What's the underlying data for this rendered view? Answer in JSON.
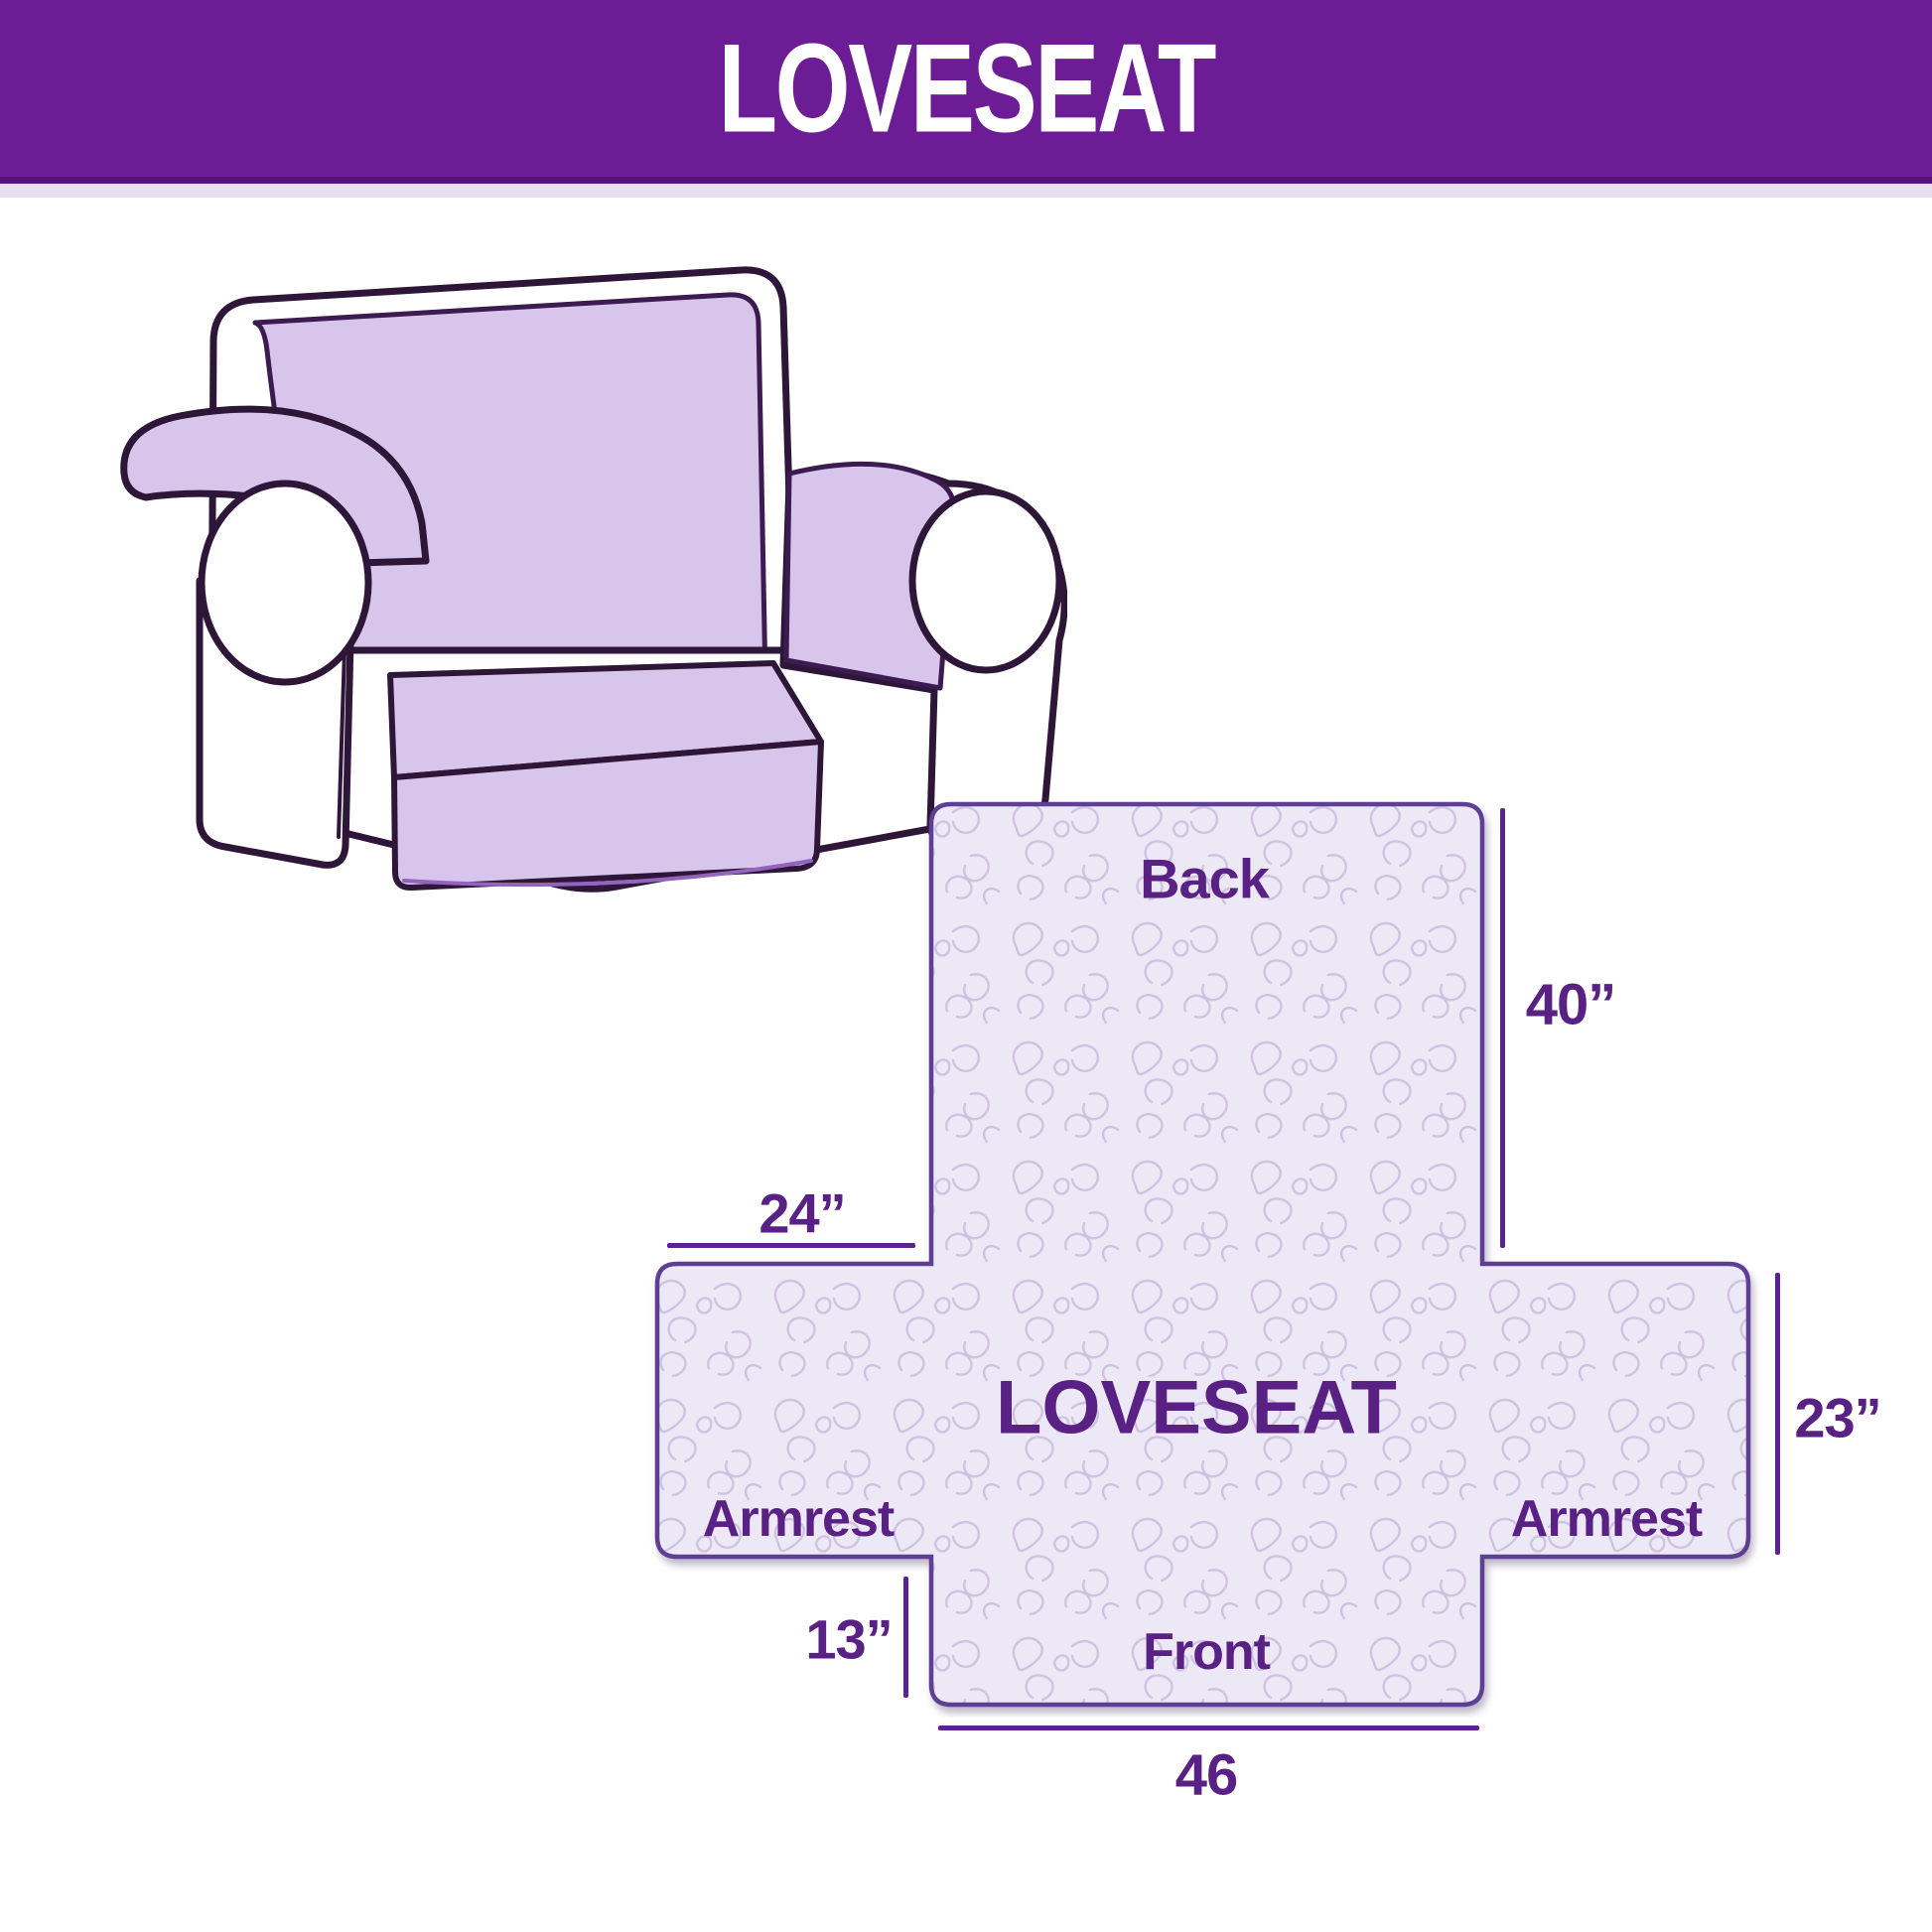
{
  "header": {
    "title": "LOVESEAT"
  },
  "illustration": {
    "name": "loveseat sofa line drawing with slipcover"
  },
  "diagram": {
    "back_label": "Back",
    "center_label": "LOVESEAT",
    "armrest_left_label": "Armrest",
    "armrest_right_label": "Armrest",
    "front_label": "Front",
    "dim_back_height": "40”",
    "dim_back_width": "24”",
    "dim_side_height": "23”",
    "dim_front_height": "13”",
    "dim_front_width": "46"
  },
  "colors": {
    "header_bg": "#6c1d95",
    "accent_text": "#5a2185",
    "dimension_line": "#5c2390",
    "cover_fill": "#d8c5eb",
    "cross_fill": "#ede8f5",
    "cross_border": "#5f3f93",
    "pattern_line": "#cfc3e1",
    "sofa_outline": "#2e1638"
  }
}
